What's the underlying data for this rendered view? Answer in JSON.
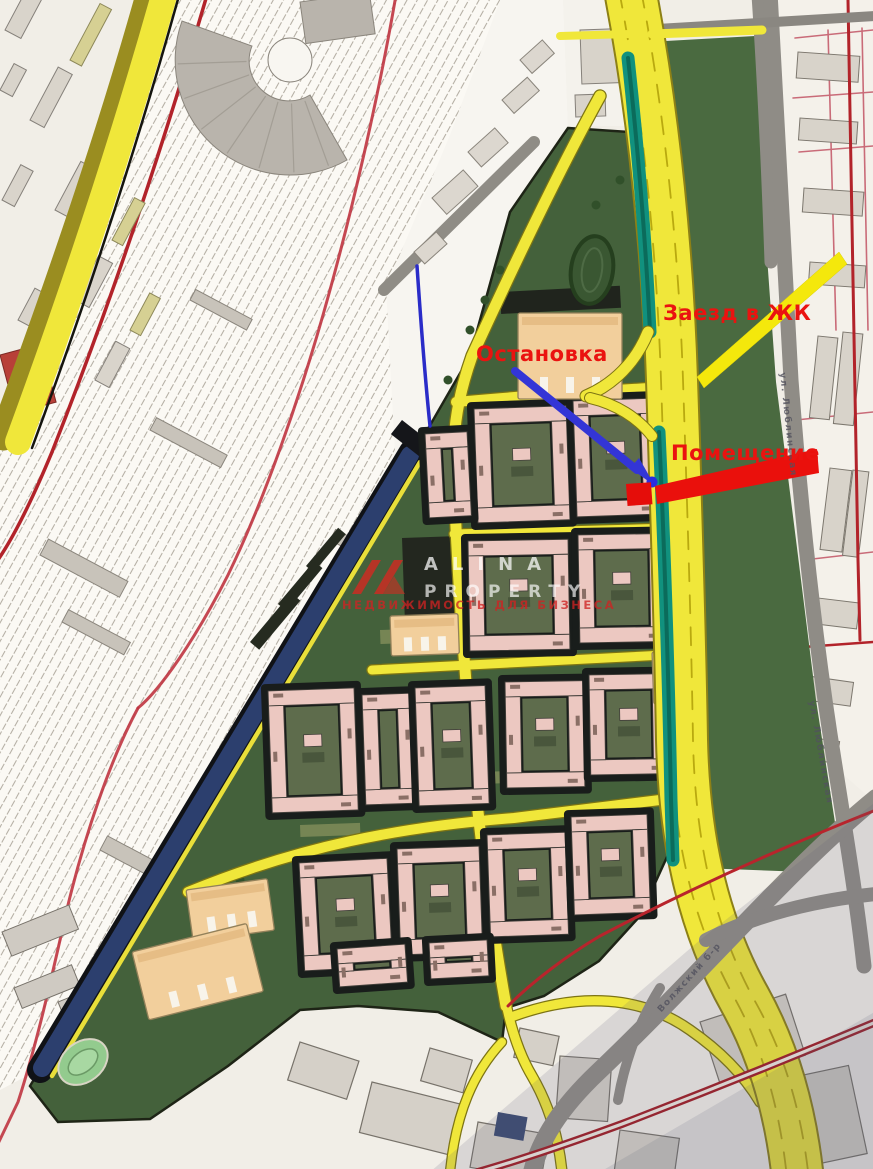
{
  "annotations": {
    "stop": {
      "label": "Остановка",
      "text_color": "#ea1310",
      "arrow_color": "#3335d6"
    },
    "entrance": {
      "label": "Заезд в ЖК",
      "text_color": "#ea1310",
      "arrow_color": "#f4e80c"
    },
    "premises": {
      "label": "Помещение",
      "text_color": "#ea1310",
      "arrow_color": "#ea100c"
    }
  },
  "street_labels": {
    "east_street_upper": "ул. Люблинская",
    "east_street_lower": "ул. Люблинская",
    "south_road": "Волжский б-р"
  },
  "watermark": {
    "brand_line1": "ALINA",
    "brand_line2": "PROPERTY",
    "tagline": "НЕДВИЖИМОСТЬ ДЛЯ БИЗНЕСА"
  },
  "map_colors": {
    "road_yellow": "#f0e73a",
    "median_teal": "#11917e",
    "park_green": "#44613b",
    "canal_navy": "#2c3f6e",
    "building_pink": "#ecc8c1",
    "building_peach": "#f2cf9c",
    "boundary_red": "#b2232a",
    "annotation_red": "#ea1310",
    "annotation_blue": "#3335d6"
  }
}
